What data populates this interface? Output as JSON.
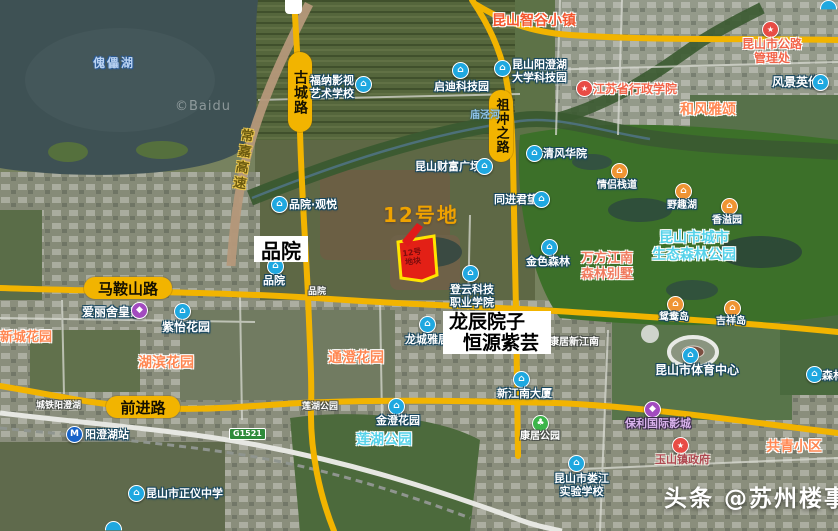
{
  "attribution": "©Baidu",
  "watermark": {
    "brand": "头条",
    "handle": "@苏州楼事"
  },
  "colors": {
    "road_highlight": "#f2b400",
    "plot_fill": "#e32016",
    "plot_border": "#ffe400",
    "callout_text": "#efa200"
  },
  "icons": {
    "building": "⌂",
    "star": "★",
    "metro": "M",
    "park": "♣",
    "shop": "◆"
  },
  "roads": {
    "gucheng": "古城路",
    "zuchongzhi": "祖冲之路",
    "maanshan": "马鞍山路",
    "qianjin": "前进路",
    "changjia": "常嘉高速",
    "g1521": "G1521"
  },
  "plot": {
    "callout": "12号地",
    "inner_line1": "12号",
    "inner_line2": "地块"
  },
  "boxes": {
    "pinyuan": "品院",
    "longchen_line1": "龙辰院子",
    "longchen_line2": "恒源紫芸"
  },
  "water": {
    "lake": "傀儡湖",
    "river": "庙泾河"
  },
  "pois": {
    "zhigu": "昆山智谷小镇",
    "funa_line1": "福纳影视",
    "funa_line2": "艺术学校",
    "qidi": "启迪科技园",
    "dxkjy_line1": "昆山阳澄湖",
    "dxkjy_line2": "大学科技园",
    "xingzheng": "江苏省行政学院",
    "gonglu_line1": "昆山市公路",
    "gonglu_line2": "管理处",
    "fengjing": "风景英伦",
    "hefeng": "和风雅颂",
    "caifu": "昆山财富广场",
    "qingfeng": "清风华院",
    "tongjin": "同进君望",
    "pinyuan_guanyue": "品院·观悦",
    "pinyuan_poi": "品院",
    "pinyuan_road": "品院",
    "jinse": "金色森林",
    "wanfang_line1": "万方江南",
    "wanfang_line2": "森林别墅",
    "shengtai_line1": "昆山市城市",
    "shengtai_line2": "生态森林公园",
    "qinglv": "情侣栈道",
    "yequ": "野趣湖",
    "xiangyi": "香溢园",
    "yuanyang": "鸳鸯岛",
    "jixiang": "吉祥岛",
    "dengyun_line1": "登云科技",
    "dengyun_line2": "职业学院",
    "longcheng": "龙城雅居",
    "ziyi": "紫怡花园",
    "ailishe": "爱丽舍皇家",
    "xincheng": "新城花园",
    "hubin": "湖滨花园",
    "tongcheng": "通澄花园",
    "chengtie": "城铁阳澄湖",
    "yangchenghu_station": "阳澄湖站",
    "zhengyi": "昆山市正仪中学",
    "lianhu_park": "莲湖公园",
    "lianhu_road": "莲湖公园",
    "jincheng": "金澄花园",
    "kangju_park": "康居公园",
    "xinjiangnan": "新江南大厦",
    "kangju_xjn": "康居新江南",
    "tiyu": "昆山市体育中心",
    "baoli": "保利国际影城",
    "loujiang_line1": "昆山市娄江",
    "loujiang_line2": "实验学校",
    "yushan": "玉山镇政府",
    "gongqing": "共青小区",
    "senlin_cut": "森林"
  }
}
